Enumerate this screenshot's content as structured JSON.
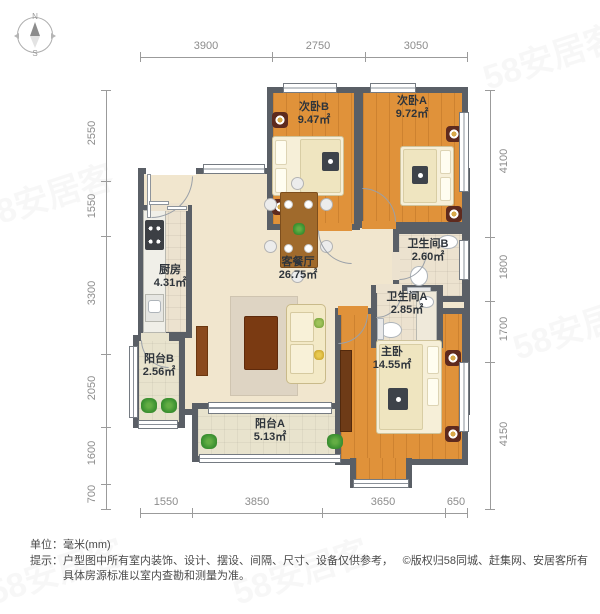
{
  "watermark": {
    "text": "58安居客"
  },
  "compass": {
    "n": "N",
    "s": "S"
  },
  "rooms": [
    {
      "id": "bedroomB",
      "name": "次卧B",
      "area": "9.47㎡"
    },
    {
      "id": "bedroomA",
      "name": "次卧A",
      "area": "9.72㎡"
    },
    {
      "id": "bathB",
      "name": "卫生间B",
      "area": "2.60㎡"
    },
    {
      "id": "bathA",
      "name": "卫生间A",
      "area": "2.85㎡"
    },
    {
      "id": "kitchen",
      "name": "厨房",
      "area": "4.31㎡"
    },
    {
      "id": "living",
      "name": "客餐厅",
      "area": "26.75㎡"
    },
    {
      "id": "balconyB",
      "name": "阳台B",
      "area": "2.56㎡"
    },
    {
      "id": "master",
      "name": "主卧",
      "area": "14.55㎡"
    },
    {
      "id": "balconyA",
      "name": "阳台A",
      "area": "5.13㎡"
    }
  ],
  "dimensions": {
    "top": [
      "3900",
      "2750",
      "3050"
    ],
    "bottom": [
      "1550",
      "3850",
      "3650",
      "650"
    ],
    "left": [
      "2550",
      "1550",
      "3300",
      "2050",
      "1600",
      "700"
    ],
    "right": [
      "4100",
      "1800",
      "1700",
      "4150"
    ]
  },
  "footer": {
    "unit": "单位：毫米(mm)",
    "tip1": "提示：户型图中所有室内装饰、设计、摆设、间隔、尺寸、设备仅供参考，",
    "tip2": "具体房源标准以室内查勘和测量为准。",
    "copyright": "©版权归58同城、赶集网、安居客所有"
  },
  "colors": {
    "wall": "#5a5f66",
    "wood_floor": "#e0923a",
    "beige_floor": "#f1e6ce",
    "accent_dark_red": "#5e2a1e"
  }
}
